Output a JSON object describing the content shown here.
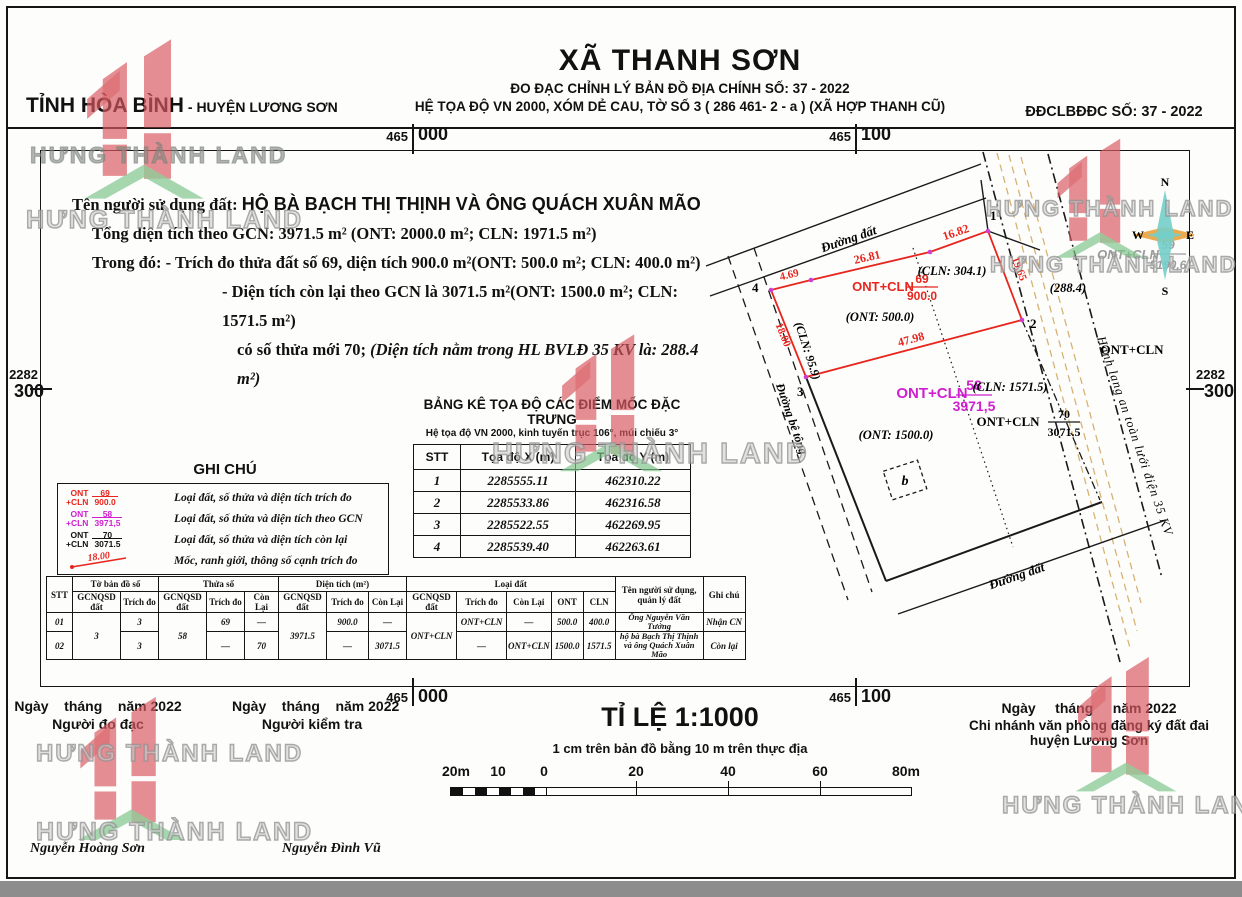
{
  "page": {
    "province": "TỈNH HÒA BÌNH",
    "district": "- HUYỆN LƯƠNG SƠN",
    "commune": "XÃ THANH SƠN",
    "subtitle1": "ĐO ĐẠC CHỈNH LÝ BẢN ĐỒ ĐỊA CHÍNH SỐ: 37 - 2022",
    "subtitle2": "HỆ TỌA ĐỘ VN 2000, XÓM DẺ CAU, TỜ SỐ 3 ( 286 461- 2 - a ) (XÃ HỢP THANH CŨ)",
    "doc_no": "ĐĐCLBĐĐC SỐ: 37 - 2022"
  },
  "grid": {
    "x_left_major": "465",
    "x_left_minor": "000",
    "x_right_major": "465",
    "x_right_minor": "100",
    "y_major": "2282",
    "y_minor": "300"
  },
  "info": {
    "owner_label": "Tên người sử dụng đất:",
    "owner": "HỘ BÀ BẠCH THỊ THỊNH VÀ ÔNG QUÁCH XUÂN MÃO",
    "line1": "Tổng diện tích theo GCN: 3971.5 m²  (ONT: 2000.0 m²; CLN: 1971.5 m²)",
    "line2_label": "Trong đó:",
    "line2": " - Trích đo thửa  đất số 69, diện tích 900.0 m²(ONT: 500.0 m²; CLN: 400.0 m²)",
    "line3": "- Diện tích còn lại theo GCN là 3071.5 m²(ONT: 1500.0 m²; CLN: 1571.5 m²)",
    "line4": "có số thửa mới 70; ",
    "line4b": "(Diện tích nằm trong HL BVLĐ 35 KV là: 288.4 m²)"
  },
  "coord_table": {
    "title": "BẢNG KÊ TỌA ĐỘ CÁC ĐIỂM MỐC ĐẶC TRƯNG",
    "subtitle": "Hệ tọa độ VN 2000, kinh tuyến trục 106°, múi chiếu 3°",
    "headers": [
      "STT",
      "Tọa độ X (m)",
      "Tọa độ Y (m)"
    ],
    "rows": [
      {
        "stt": "1",
        "x": "2285555.11",
        "y": "462310.22"
      },
      {
        "stt": "2",
        "x": "2285533.86",
        "y": "462316.58"
      },
      {
        "stt": "3",
        "x": "2285522.55",
        "y": "462269.95"
      },
      {
        "stt": "4",
        "x": "2285539.40",
        "y": "462263.61"
      }
    ]
  },
  "legend": {
    "title": "GHI CHÚ",
    "items": [
      {
        "left1": "ONT",
        "left2": "+CLN",
        "num": "69",
        "den": "900.0",
        "text": "Loại đất, số thửa và diện tích trích đo"
      },
      {
        "left1": "ONT",
        "left2": "+CLN",
        "num": "58",
        "den": "3971,5",
        "text": "Loại đất, số thửa và diện tích theo GCN"
      },
      {
        "left1": "ONT",
        "left2": "+CLN",
        "num": "70",
        "den": "3071.5",
        "text": "Loại đất, số thửa và diện tích còn lại"
      },
      {
        "edge_value": "18.00",
        "text": "Mốc, ranh giới, thông số cạnh trích đo"
      }
    ]
  },
  "summary_table": {
    "groups": {
      "stt": "STT",
      "map_sheet": "Tờ bản đồ số",
      "plot": "Thửa số",
      "area": "Diện tích (m²)",
      "land_type": "Loại đất",
      "owner": "Tên người sử dụng, quản lý đất",
      "note": "Ghi chú"
    },
    "sub": {
      "gcn": "GCNQSD đất",
      "td": "Trích đo",
      "cl": "Còn Lại",
      "ont": "ONT",
      "cln": "CLN"
    },
    "rows": [
      {
        "stt": "01",
        "map_gcn": "3",
        "map_td": "3",
        "plot_gcn": "58",
        "plot_td": "69",
        "plot_cl": "—",
        "area_gcn": "3971.5",
        "area_td": "900.0",
        "area_cl": "—",
        "type_gcn": "ONT+CLN",
        "type_td": "ONT+CLN",
        "type_cl": "—",
        "ont": "500.0",
        "cln": "400.0",
        "owner": "Ông Nguyễn Văn Tưởng",
        "note": "Nhận CN"
      },
      {
        "stt": "02",
        "map_td": "3",
        "plot_td": "—",
        "plot_cl": "70",
        "area_td": "—",
        "area_cl": "3071.5",
        "type_td": "—",
        "type_cl": "ONT+CLN",
        "ont": "1500.0",
        "cln": "1571.5",
        "owner": "hộ bà Bạch Thị Thịnh và ông Quách Xuân Mão",
        "note": "Còn lại"
      }
    ]
  },
  "map": {
    "roads": {
      "top": "Đường đất",
      "left": "Đường bê tông",
      "bottom": "Đường đất"
    },
    "corridor": "Hành lang an toàn lưới điện 35 KV",
    "points": [
      "1",
      "2",
      "3",
      "4"
    ],
    "edges": {
      "e1": "4.69",
      "e2": "26.81",
      "e3": "16.82",
      "e4": "19.65",
      "e5": "47.98",
      "e6": "18.00"
    },
    "p69": {
      "type": "ONT+CLN",
      "num": "69",
      "den": "900.0",
      "ont": "(ONT: 500.0)",
      "cln": "(CLN: 304.1)",
      "cln_left": "(CLN: 95.9)"
    },
    "p58": {
      "type": "ONT+CLN",
      "num": "58",
      "den": "3971,5",
      "ont": "(ONT: 1500.0)",
      "cln": "(CLN: 1571.5)"
    },
    "p70": {
      "type": "ONT+CLN",
      "num": "70",
      "den": "3071.5"
    },
    "p59": {
      "type": "ONT+CLN",
      "num": "59",
      "den": "5190,6"
    },
    "adj_label": "ONT+CLN",
    "hl_area": "(288.4)",
    "b_label": "b",
    "compass": {
      "n": "N",
      "e": "E",
      "s": "S",
      "w": "W"
    }
  },
  "footer": {
    "scale_title": "TỈ LỆ 1:1000",
    "scale_note": "1 cm trên bản đồ bằng 10 m trên thực địa",
    "scalebar_labels": [
      "20m",
      "10",
      "0",
      "20",
      "40",
      "60",
      "80m"
    ],
    "sign1": {
      "date": "Ngày    tháng    năm 2022",
      "role": "Người đo đạc",
      "name": "Nguyễn Hoàng Sơn"
    },
    "sign2": {
      "date": "Ngày    tháng    năm 2022",
      "role": "Người kiểm tra",
      "name": "Nguyễn Đình Vũ"
    },
    "sign3": {
      "date": "Ngày     tháng     năm 2022",
      "role1": "Chi nhánh văn phòng đăng ký đất đai",
      "role2": "huyện Lương Sơn"
    }
  },
  "watermark": {
    "text": "HƯNG THÀNH LAND"
  },
  "colors": {
    "map_red": "#e8251d",
    "map_magenta": "#cf1fcf",
    "map_gray": "#9b9b9b",
    "wm_red": "#d85960",
    "wm_green": "#7dc489",
    "compass_teal": "#74cec9",
    "compass_orange": "#e9a23b",
    "corridor_tan": "#d8b274"
  }
}
